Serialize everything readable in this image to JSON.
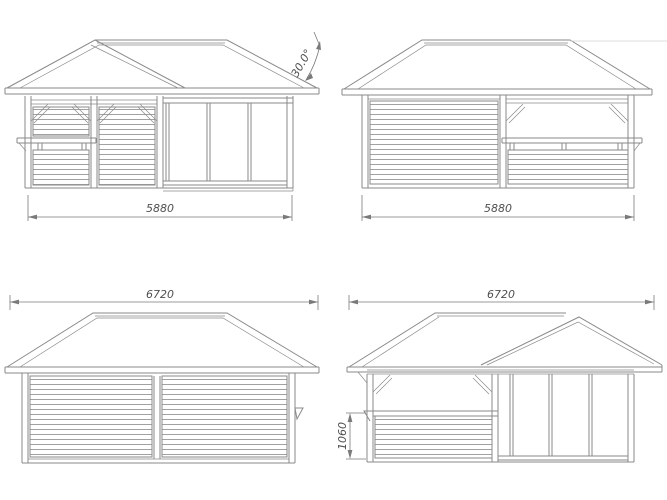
{
  "colors": {
    "background": "#ffffff",
    "line": "#8a8a8a",
    "line_faint": "#d2d2d2",
    "dimension": "#7a7a7a",
    "text": "#4f4f4f"
  },
  "drawing": {
    "views": [
      {
        "name": "front-elevation",
        "width_label": "5880",
        "roof_angle_label": "30.0°"
      },
      {
        "name": "rear-elevation",
        "width_label": "5880"
      },
      {
        "name": "side-elevation-closed",
        "width_label": "6720"
      },
      {
        "name": "side-elevation-bar",
        "width_label": "6720",
        "bar_wall_height_label": "1060"
      }
    ]
  }
}
